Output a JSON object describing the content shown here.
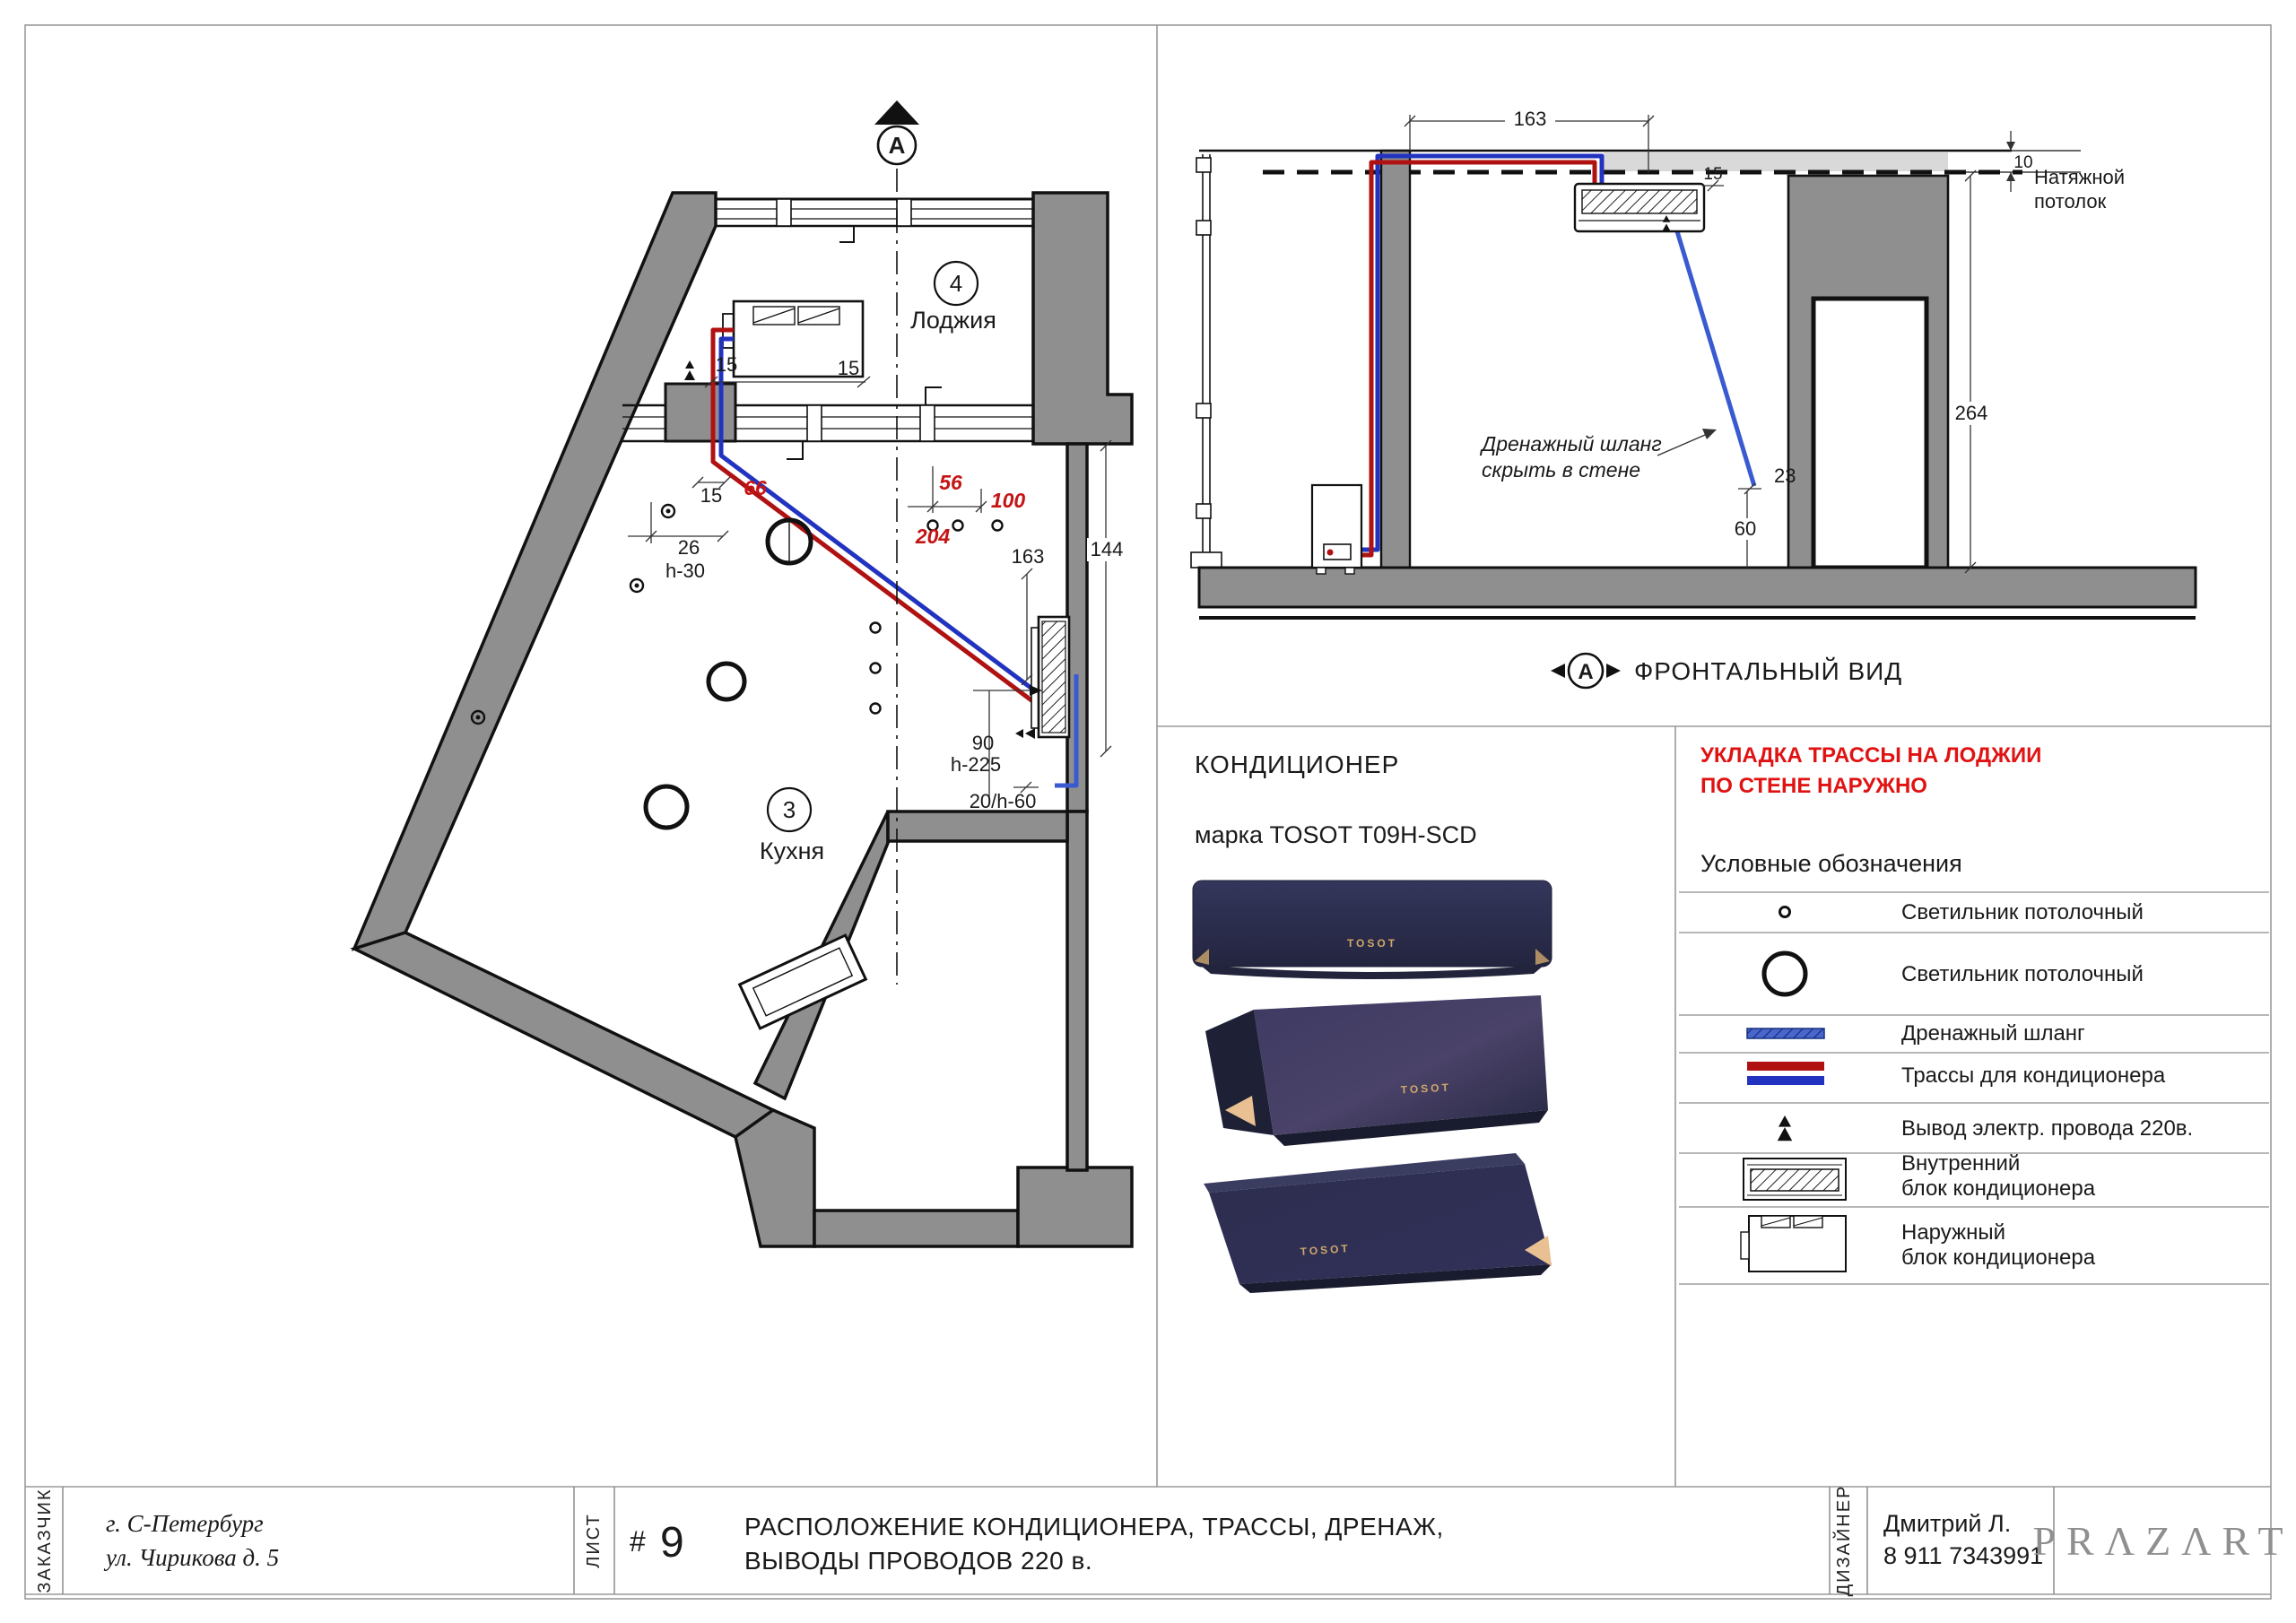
{
  "colors": {
    "wall_gray": "#8f8f8f",
    "light_gray": "#d9d9d9",
    "trace_red": "#b01111",
    "trace_blue": "#2233c0",
    "drain_blue": "#3a5bd0",
    "note_red": "#e01212",
    "unit_navy": "#2e3052",
    "gold": "#c8a36a",
    "logo_gray": "#8f8f8f"
  },
  "plan": {
    "section_marker": "A",
    "rooms": [
      {
        "number": "4",
        "name": "Лоджия"
      },
      {
        "number": "3",
        "name": "Кухня"
      }
    ],
    "dims": {
      "d15a": "15",
      "d15b": "15",
      "d15c": "15",
      "d66": "66",
      "d26": "26",
      "h30": "h-30",
      "d56": "56",
      "d100": "100",
      "d204": "204",
      "d163": "163",
      "d144": "144",
      "d90": "90",
      "h225": "h-225",
      "d20h60": "20/h-60"
    }
  },
  "front_view": {
    "label": "ФРОНТАЛЬНЫЙ ВИД",
    "marker": "A",
    "ceiling_label_1": "Натяжной",
    "ceiling_label_2": "потолок",
    "drain_note_1": "Дренажный шланг",
    "drain_note_2": "скрыть в стене",
    "dims": {
      "d163": "163",
      "d15": "15",
      "d10": "10",
      "d264": "264",
      "d23": "23",
      "d60": "60"
    }
  },
  "unit_info": {
    "title": "КОНДИЦИОНЕР",
    "model": "марка TOSOT T09H-SCD",
    "brand": "TOSOT"
  },
  "notes": {
    "red_line1": "УКЛАДКА ТРАССЫ НА ЛОДЖИИ",
    "red_line2": "ПО СТЕНЕ НАРУЖНО"
  },
  "legend": {
    "title": "Условные обозначения",
    "rows": [
      {
        "label": "Светильник потолочный"
      },
      {
        "label": "Светильник потолочный"
      },
      {
        "label": "Дренажный шланг"
      },
      {
        "label": "Трассы для кондиционера"
      },
      {
        "label": "Вывод электр. провода 220в."
      },
      {
        "label": "Внутренний",
        "label2": "блок кондиционера"
      },
      {
        "label": "Наружный",
        "label2": "блок кондиционера"
      }
    ]
  },
  "title_block": {
    "customer_label": "ЗАКАЗЧИК",
    "customer_line1": "г. С-Петербург",
    "customer_line2": "ул. Чирикова д. 5",
    "sheet_label": "ЛИСТ",
    "sheet_hash": "#",
    "sheet_number": "9",
    "title_line1": "РАСПОЛОЖЕНИЕ КОНДИЦИОНЕРА, ТРАССЫ, ДРЕНАЖ,",
    "title_line2": "ВЫВОДЫ ПРОВОДОВ 220 в.",
    "designer_label": "ДИЗАЙНЕР",
    "designer_name": "Дмитрий Л.",
    "designer_phone": "8 911 7343991",
    "logo": "PRΛZΛRT"
  }
}
